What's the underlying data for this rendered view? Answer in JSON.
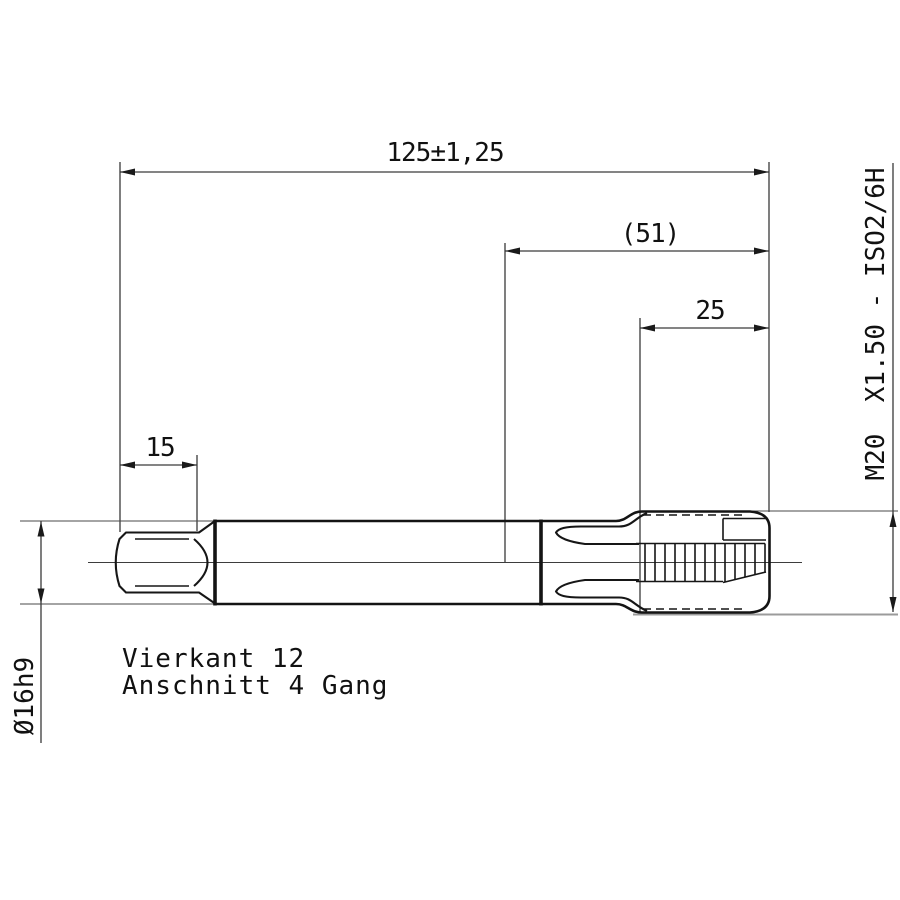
{
  "drawing": {
    "type_note": "technical drawing of a machine tap (Maschinengewindebohrer), side view",
    "labels": {
      "overall_length": "125±1,25",
      "head_length": "(51)",
      "thread_length": "25",
      "square_length": "15",
      "shank_diameter": "Ø16h9",
      "thread_designation": "M20  X1.50 - ISO2/6H",
      "note_line1": "Vierkant 12",
      "note_line2": "Anschnitt 4 Gang"
    },
    "colors": {
      "outline": "#141414",
      "dimension_lines": "#3a3a3a",
      "ground_line": "#9b9b9b",
      "text": "#111111",
      "background": "#ffffff"
    }
  }
}
